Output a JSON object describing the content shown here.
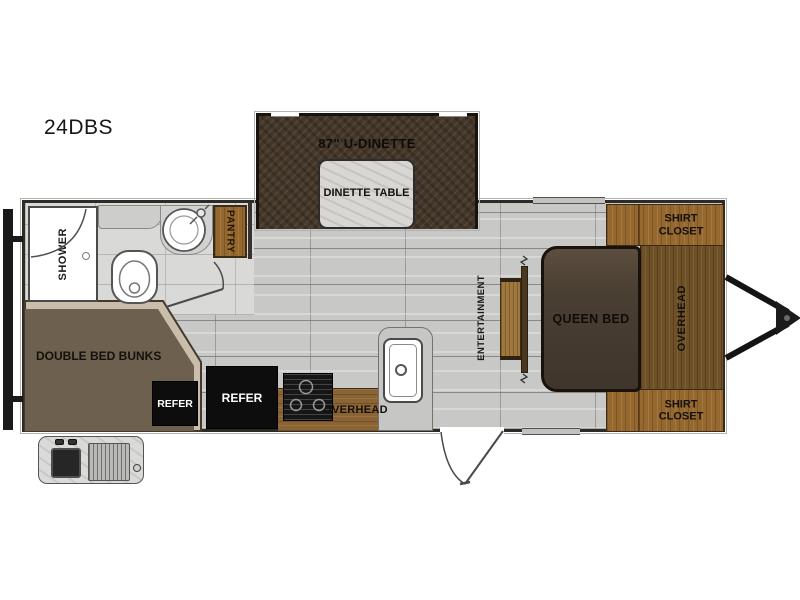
{
  "title": "24DBS",
  "floorplan": {
    "slide_out": {
      "dinette_label": "87\" U-DINETTE",
      "table_label": "DINETTE TABLE"
    },
    "bathroom": {
      "shower_label": "SHOWER",
      "pantry_label": "PANTRY"
    },
    "rear_bedroom": {
      "bunks_label": "DOUBLE BED BUNKS",
      "refer_label": "REFER"
    },
    "kitchen": {
      "refer_label": "REFER",
      "overhead_label": "OVERHEAD"
    },
    "living": {
      "entertainment_label": "ENTERTAINMENT"
    },
    "front_bedroom": {
      "queen_bed_label": "QUEEN BED",
      "overhead_label": "OVERHEAD",
      "shirt_closet_top_label": "SHIRT CLOSET",
      "shirt_closet_bottom_label": "SHIRT CLOSET"
    }
  },
  "colors": {
    "wall": "#2e2a26",
    "floor_gray": "#c8c8c6",
    "wood_light": "#95682f",
    "wood_dark": "#6e5128",
    "dinette_brown": "#44372a",
    "bunk_brown": "#6e604f",
    "bed_brown": "#4a3f33",
    "appliance_black": "#0d0d0d",
    "table_gray": "#d8d7d4"
  }
}
